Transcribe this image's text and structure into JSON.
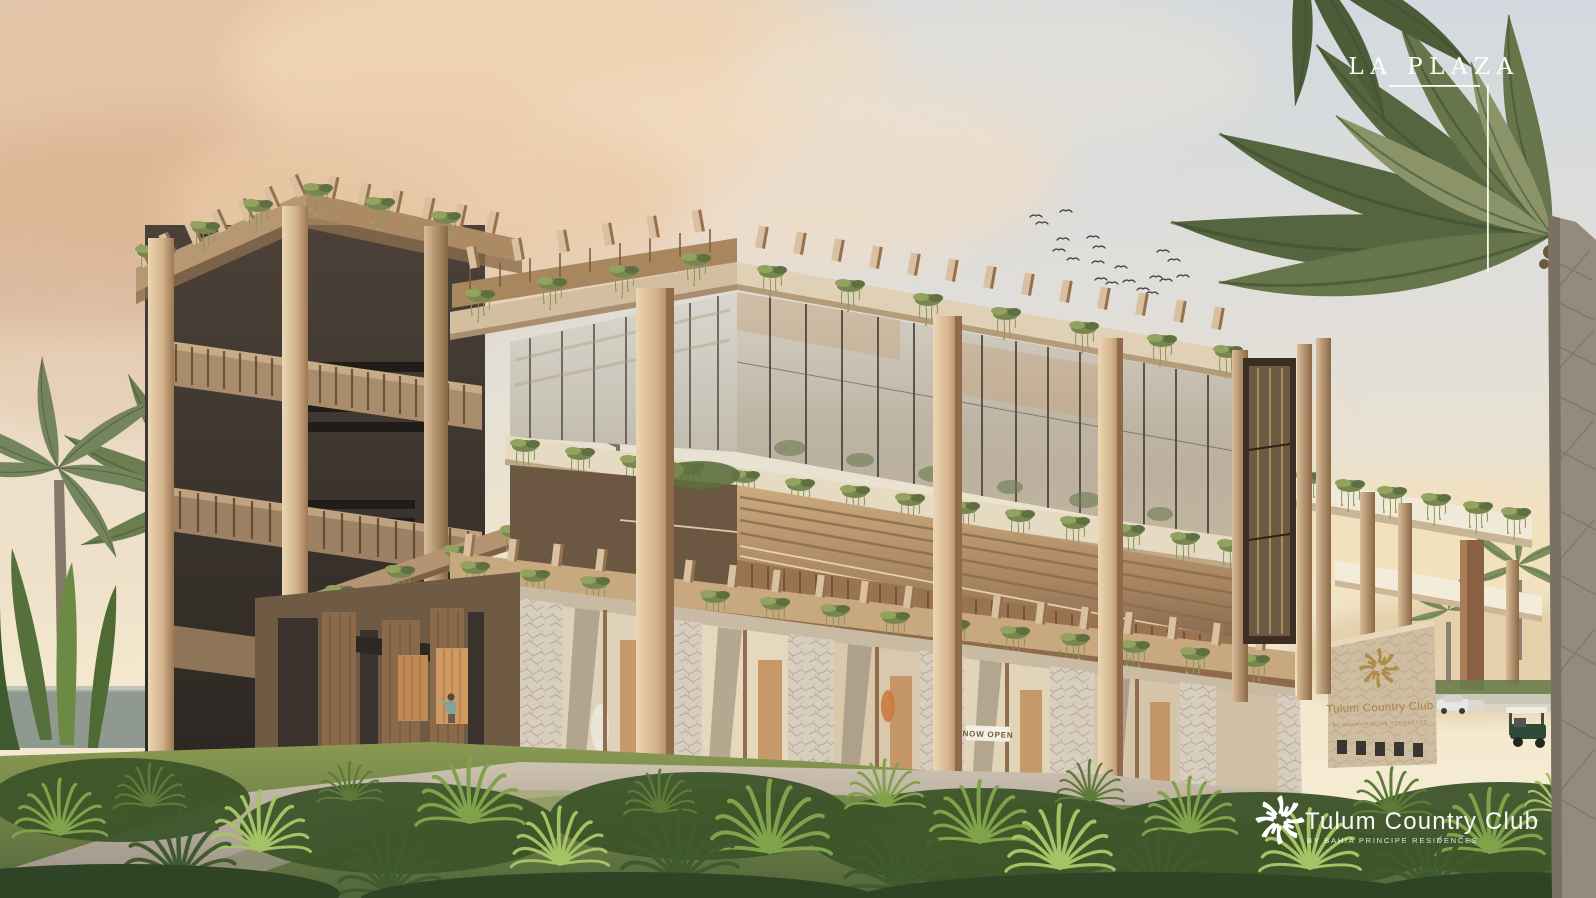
{
  "overlay": {
    "plaza_label": "LA PLAZA",
    "watermark_brand": "Tulum Country Club",
    "watermark_sub": "BY BAHIA PRINCIPE RESIDENCES"
  },
  "building_sign": {
    "brand": "Tulum Country Club",
    "sub": "BY BAHIA PRINCIPE RESIDENCES"
  },
  "storefront": {
    "now_open_sign": "NOW OPEN"
  },
  "icons": {
    "sunburst_logo": "sunburst-logo-icon"
  },
  "colors": {
    "sky_top": "#d4dade",
    "sky_warm_horizon": "#f5e9cf",
    "cloud_peach": "#e6c2a0",
    "wood_light": "#dcc3a2",
    "wood_mid": "#b08a63",
    "wood_dark": "#6f5137",
    "fascia_beige": "#ddcaae",
    "stone": "#d6cbba",
    "glass": "#c9c4b9",
    "foliage_dark": "#3f5a2e",
    "foliage_mid": "#6b8a43",
    "foliage_light": "#9cb85f",
    "sign_gold": "#a8834a",
    "text_white": "#fdfdf8",
    "path_grey": "#b3a697"
  }
}
